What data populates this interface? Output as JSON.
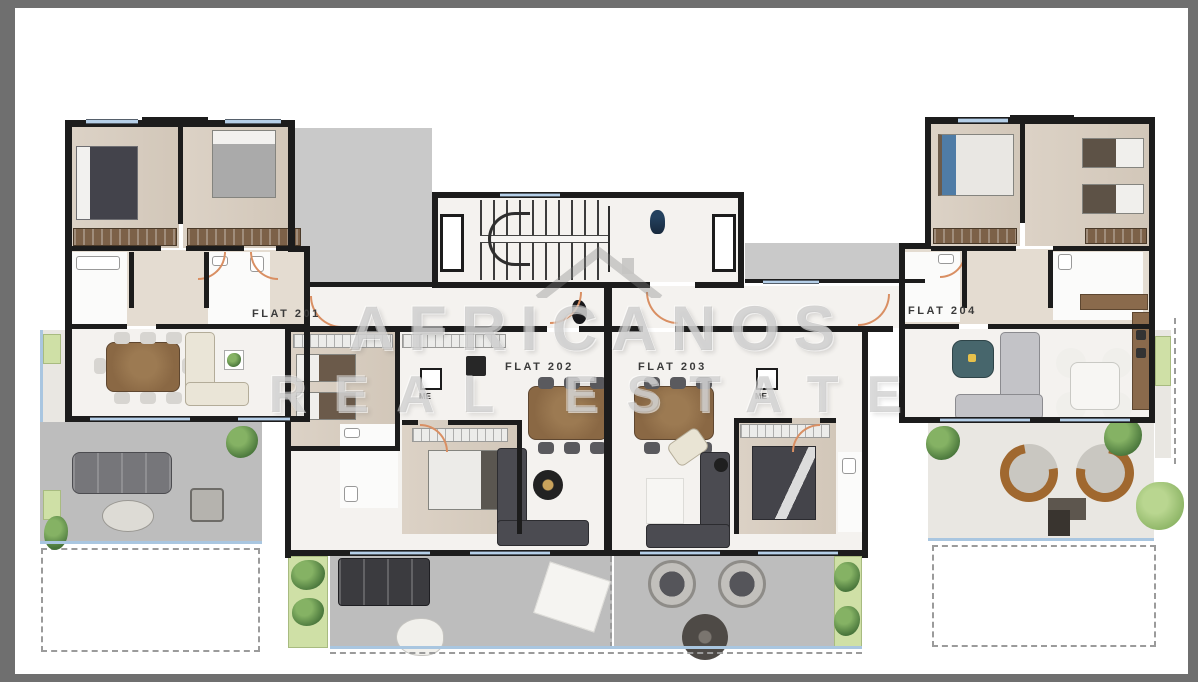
{
  "page": {
    "frame_color": "#6f6f6f",
    "paper_color": "#ffffff"
  },
  "plan": {
    "flats": [
      {
        "id": "201",
        "label": "FLAT 201"
      },
      {
        "id": "202",
        "label": "FLAT 202"
      },
      {
        "id": "203",
        "label": "FLAT 203"
      },
      {
        "id": "204",
        "label": "FLAT 204"
      }
    ],
    "utility_labels": [
      {
        "label": "ME"
      },
      {
        "label": "ME"
      }
    ],
    "watermark": {
      "name": "AFRICANOS",
      "tagline": "REAL ESTATE",
      "logo": "house-roof-icon"
    },
    "icons": {
      "lobby_figure": "person-icon",
      "corridor_decor": "statue-icon",
      "stairwell": "stairs-icon",
      "plants": "plant-icon"
    }
  },
  "colors": {
    "wall": "#1c1c1c",
    "grey_wall": "#8f8f8f",
    "wood_floor": "#d8cec2",
    "marble_floor": "#f4f2ef",
    "terrace_floor": "#bdbdbd",
    "roof": "#c9c9c9",
    "glass": "#b5cfe8",
    "door_swing": "#d98f63",
    "plant_green": "#47743a",
    "watermark_grey": "#8a8a8a"
  }
}
